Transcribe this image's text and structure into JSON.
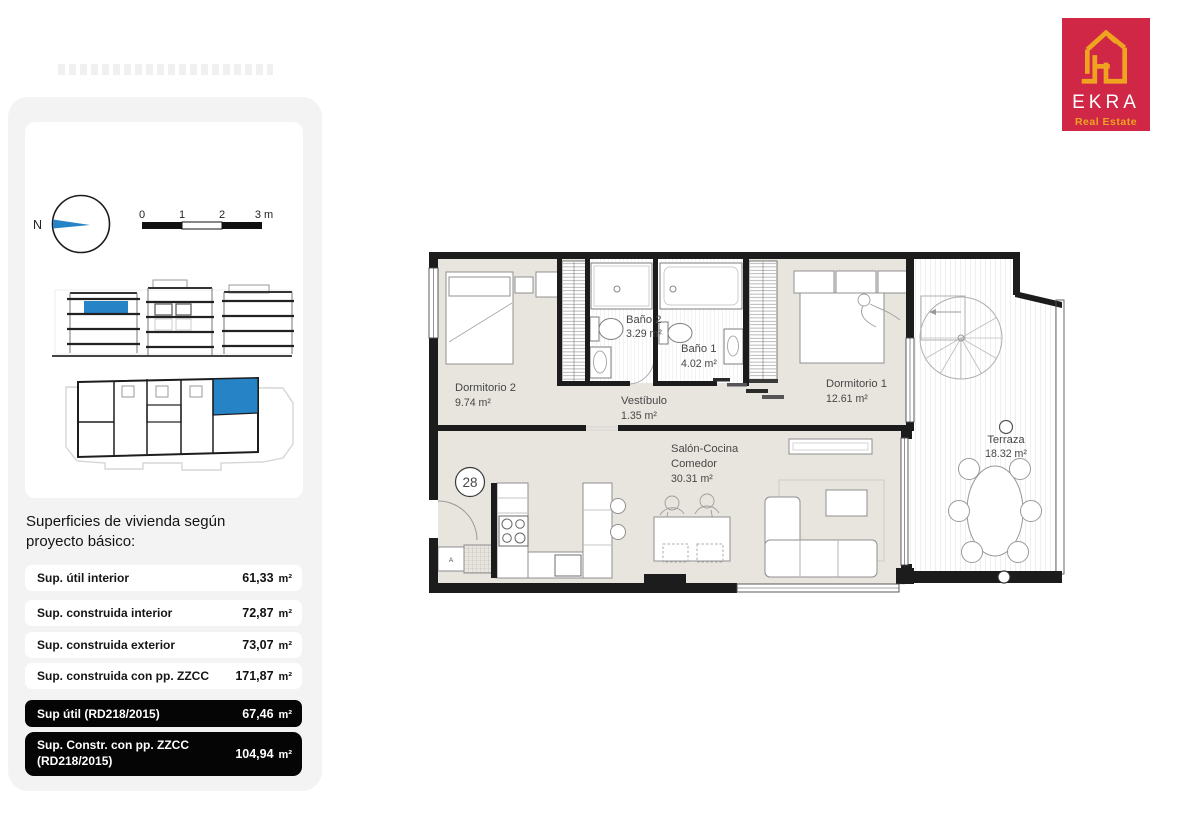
{
  "logo": {
    "brand": "EKRA",
    "tagline": "Real Estate",
    "bg_color": "#d02747",
    "accent_color": "#efa41f"
  },
  "panel": {
    "compass": "N",
    "scale": {
      "t0": "0",
      "t1": "1",
      "t2": "2",
      "t3": "3 m"
    },
    "heading": "Superficies de vivienda según proyecto básico:",
    "rows": [
      {
        "label": "Sup. útil interior",
        "value": "61,33",
        "unit": "m²",
        "style": "light"
      },
      {
        "label": "Sup. construida interior",
        "value": "72,87",
        "unit": "m²",
        "style": "light"
      },
      {
        "label": "Sup. construida exterior",
        "value": "73,07",
        "unit": "m²",
        "style": "light"
      },
      {
        "label": "Sup. construida con pp. ZZCC",
        "value": "171,87",
        "unit": "m²",
        "style": "light"
      },
      {
        "label": "Sup útil (RD218/2015)",
        "value": "67,46",
        "unit": "m²",
        "style": "dark"
      },
      {
        "label": "Sup. Constr. con pp. ZZCC (RD218/2015)",
        "value": "104,94",
        "unit": "m²",
        "style": "dark"
      }
    ]
  },
  "floorplan": {
    "unit_number": "28",
    "closet_label": "A",
    "rooms": {
      "dorm2": {
        "name": "Dormitorio 2",
        "area": "9.74 m²"
      },
      "bano2": {
        "name": "Baño 2",
        "area": "3.29 m²"
      },
      "bano1": {
        "name": "Baño 1",
        "area": "4.02 m²"
      },
      "vestibulo": {
        "name": "Vestíbulo",
        "area": "1.35 m²"
      },
      "dorm1": {
        "name": "Dormitorio 1",
        "area": "12.61 m²"
      },
      "salon": {
        "name_line1": "Salón-Cocina",
        "name_line2": "Comedor",
        "area": "30.31 m²"
      },
      "terraza": {
        "name": "Terraza",
        "area": "18.32 m²"
      }
    },
    "colors": {
      "floor": "#e8e4de",
      "wall": "#1c1c1c",
      "accent_blue": "#2583c6"
    }
  }
}
